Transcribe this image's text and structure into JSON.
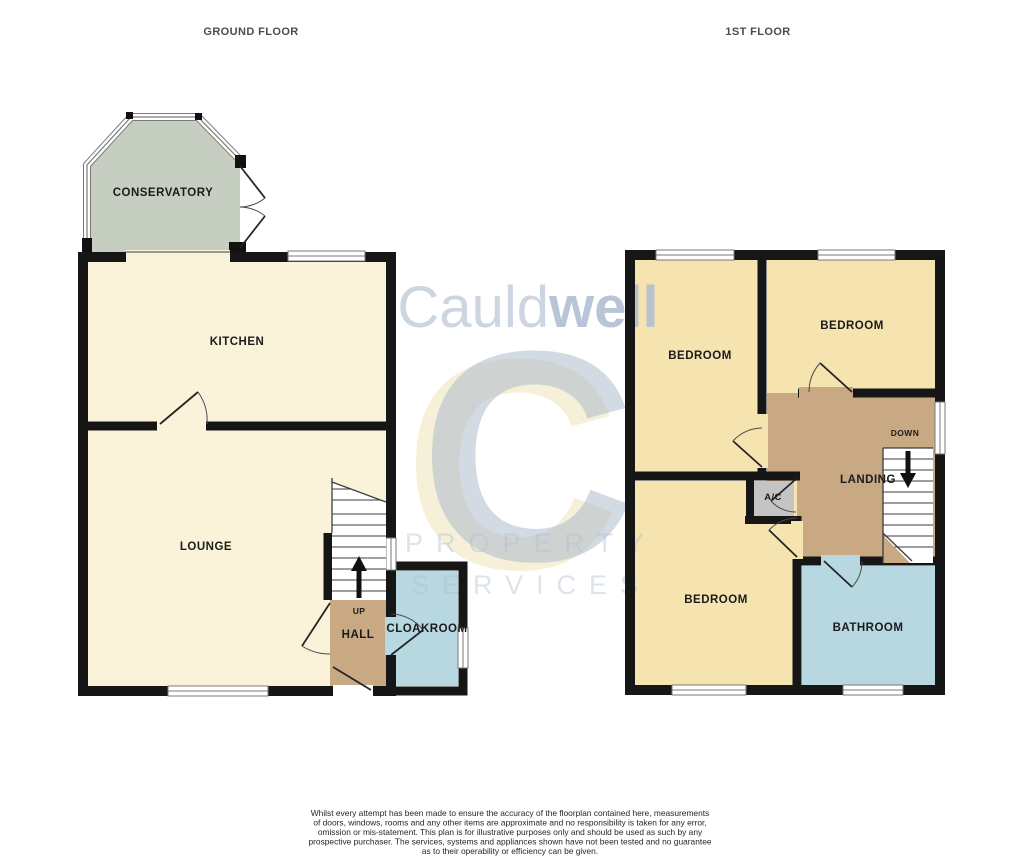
{
  "headers": {
    "ground": "GROUND FLOOR",
    "first": "1ST FLOOR"
  },
  "ground_floor": {
    "labels": {
      "conservatory": "CONSERVATORY",
      "kitchen": "KITCHEN",
      "lounge": "LOUNGE",
      "hall": "HALL",
      "cloakroom": "CLOAKROOM",
      "stairs_direction": "UP"
    }
  },
  "first_floor": {
    "labels": {
      "bedroom_top_left": "BEDROOM",
      "bedroom_top_right": "BEDROOM",
      "bedroom_bottom": "BEDROOM",
      "airing_cupboard": "A/C",
      "landing": "LANDING",
      "bathroom": "BATHROOM",
      "stairs_direction": "DOWN"
    }
  },
  "watermark": {
    "brand_prefix": "Cauld",
    "brand_suffix": "well",
    "monogram": "C",
    "line1": "PROPERTY",
    "line2": "SERVICES"
  },
  "disclaimer": {
    "lines": [
      "Whilst every attempt has been made to ensure the accuracy of the floorplan contained here, measurements",
      "of doors, windows, rooms and any other items are approximate and no responsibility is taken for any error,",
      "omission or mis-statement. This plan is for illustrative purposes only and should be used as such by any",
      "prospective purchaser. The services, systems and appliances shown have not been tested and no guarantee",
      "as to their operability or efficiency can be given.",
      "Made with Metropix ©2025"
    ]
  },
  "colors": {
    "room_cream": "#faf3da",
    "room_gold": "#f5e3b0",
    "room_tan": "#c8a983",
    "room_blue": "#b7d7e1",
    "room_sage": "#c6cec2",
    "room_gray": "#c4c4c4",
    "wall": "#161616",
    "window_frame": "#7a7a7a",
    "label": "#1b1b1b",
    "floor_label": "#4c4c4c",
    "disclaimer": "#262626",
    "wm_light": "#c9d2de",
    "wm_dark": "#b3c1d3",
    "wm_gray": "#aebcce",
    "wm_yellow": "#eee3b4",
    "wm_sub": "#b0becf"
  }
}
